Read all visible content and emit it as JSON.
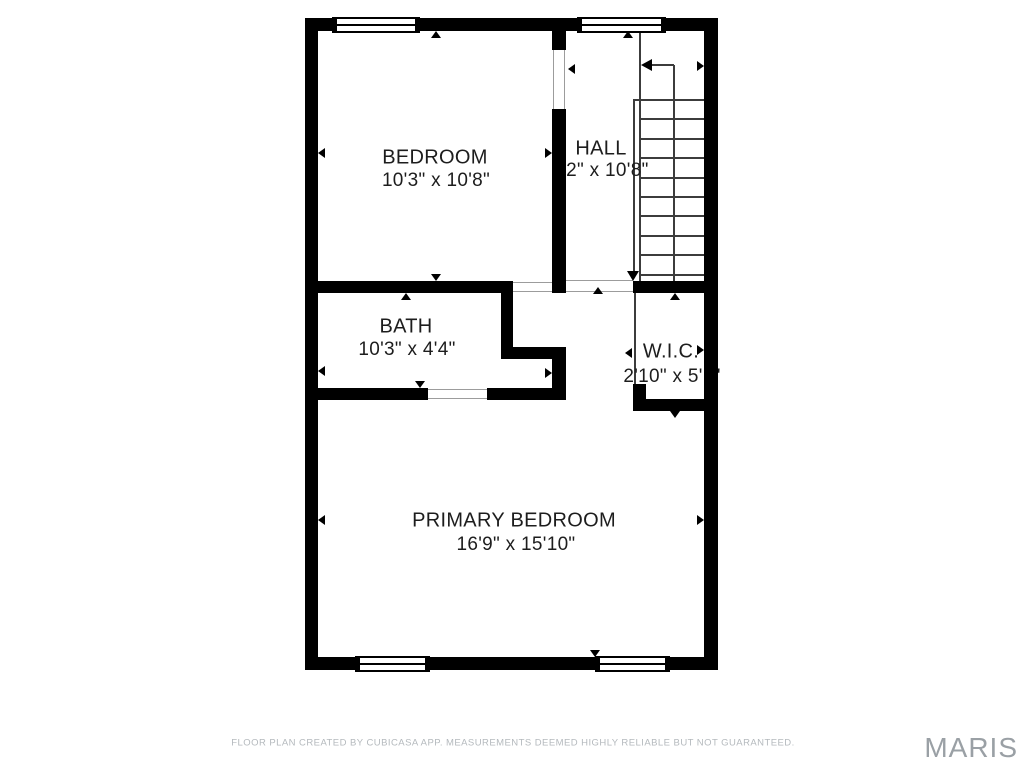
{
  "rooms": [
    {
      "label": "BEDROOM",
      "dims": "10'3\" x 10'8\""
    },
    {
      "label": "HALL",
      "dims": "3'2\" x 10'8\""
    },
    {
      "label": "BATH",
      "dims": "10'3\" x 4'4\""
    },
    {
      "label": "W.I.C.",
      "dims": "2'10\" x 5'1\""
    },
    {
      "label": "PRIMARY BEDROOM",
      "dims": "16'9\" x 15'10\""
    }
  ],
  "footer": {
    "disclaimer": "FLOOR PLAN CREATED BY CUBICASA APP. MEASUREMENTS DEEMED HIGHLY RELIABLE BUT NOT GUARANTEED."
  },
  "watermark": {
    "text": "MARIS"
  },
  "colors": {
    "wall": "#000000",
    "room_text": "#1d1d1d",
    "thin_line": "#3c3c3c",
    "door_threshold": "#9c9c9c",
    "footer_text": "#b4b9bd",
    "watermark_text": "#9aa0a5",
    "background": "#ffffff"
  },
  "floorplan": {
    "walls": [
      [
        305,
        18,
        413,
        13,
        "top-wall"
      ],
      [
        305,
        657,
        413,
        13,
        "bottom-wall"
      ],
      [
        305,
        18,
        13,
        652,
        "left-wall"
      ],
      [
        704,
        18,
        14,
        652,
        "right-wall"
      ],
      [
        552,
        31,
        14,
        19,
        "hall-bedroom-wall-upper"
      ],
      [
        552,
        109,
        14,
        184,
        "hall-bedroom-wall-main"
      ],
      [
        552,
        347,
        14,
        53,
        "hall-bedroom-wall-lower"
      ],
      [
        318,
        281,
        183,
        12,
        "bedroom-bath-wall"
      ],
      [
        501,
        281,
        12,
        78,
        "closet-left-wall"
      ],
      [
        501,
        347,
        65,
        12,
        "closet-bottom-wall"
      ],
      [
        318,
        388,
        110,
        12,
        "bath-bottom-wall-left"
      ],
      [
        487,
        388,
        79,
        12,
        "bath-bottom-wall-right"
      ],
      [
        633,
        281,
        71,
        12,
        "stairs-bottom-wall"
      ],
      [
        633,
        384,
        13,
        15,
        "wic-corner-stub"
      ],
      [
        633,
        399,
        71,
        12,
        "wic-bottom-wall"
      ]
    ],
    "thin_lines": [
      [
        639,
        31,
        2,
        250,
        "stairs-edge-line"
      ],
      [
        633,
        99,
        2,
        173,
        "stair-railing-line"
      ],
      [
        673,
        65,
        2,
        216,
        "stair-walk-line"
      ],
      [
        650,
        64,
        24,
        2,
        "stair-arrow-tail"
      ],
      [
        633,
        99,
        71,
        2,
        "stair-tread-1"
      ],
      [
        640,
        118,
        64,
        2,
        "stair-tread-2"
      ],
      [
        640,
        138,
        64,
        2,
        "stair-tread-3"
      ],
      [
        640,
        157,
        64,
        2,
        "stair-tread-4"
      ],
      [
        640,
        177,
        64,
        2,
        "stair-tread-5"
      ],
      [
        640,
        196,
        64,
        2,
        "stair-tread-6"
      ],
      [
        640,
        215,
        64,
        2,
        "stair-tread-7"
      ],
      [
        640,
        235,
        64,
        2,
        "stair-tread-8"
      ],
      [
        640,
        254,
        64,
        2,
        "stair-tread-9"
      ],
      [
        640,
        274,
        64,
        2,
        "stair-tread-10"
      ],
      [
        634,
        293,
        2,
        106,
        "wic-door-line"
      ]
    ],
    "thresholds": [
      [
        553,
        50,
        1,
        59,
        "bedroom-door-jamb-left"
      ],
      [
        564,
        50,
        1,
        59,
        "bedroom-door-jamb-right"
      ],
      [
        513,
        282,
        40,
        1,
        "closet-door-edge-top"
      ],
      [
        513,
        291,
        40,
        1,
        "closet-door-edge-bottom"
      ],
      [
        428,
        389,
        59,
        1,
        "bath-door-edge-top"
      ],
      [
        428,
        398,
        59,
        1,
        "bath-door-edge-bottom"
      ],
      [
        566,
        280,
        67,
        1,
        "hall-opening-edge-top"
      ],
      [
        566,
        291,
        67,
        1,
        "hall-opening-edge-bottom"
      ]
    ],
    "windows": [
      [
        332,
        17,
        88,
        16,
        "bedroom-window"
      ],
      [
        577,
        17,
        89,
        16,
        "hall-window"
      ],
      [
        355,
        656,
        75,
        16,
        "primary-bedroom-window-left"
      ],
      [
        595,
        656,
        75,
        16,
        "primary-bedroom-window-right"
      ]
    ],
    "ticks": [
      [
        436,
        31,
        "up",
        "tick-bedroom-top"
      ],
      [
        628,
        31,
        "up",
        "tick-hall-top"
      ],
      [
        318,
        153,
        "left",
        "tick-bedroom-left"
      ],
      [
        552,
        153,
        "right",
        "tick-bedroom-right"
      ],
      [
        568,
        69,
        "left",
        "tick-hall-left"
      ],
      [
        704,
        66,
        "right",
        "tick-hall-right"
      ],
      [
        436,
        281,
        "down",
        "tick-bedroom-bottom"
      ],
      [
        406,
        293,
        "up",
        "tick-bath-top"
      ],
      [
        318,
        371,
        "left",
        "tick-bath-left"
      ],
      [
        552,
        373,
        "right",
        "tick-bath-right"
      ],
      [
        420,
        388,
        "down",
        "tick-bath-bottom"
      ],
      [
        598,
        287,
        "up",
        "tick-corridor-opening"
      ],
      [
        675,
        293,
        "up",
        "tick-wic-top"
      ],
      [
        625,
        353,
        "left",
        "tick-wic-left"
      ],
      [
        704,
        350,
        "right",
        "tick-wic-right"
      ],
      [
        675,
        418,
        "down",
        "tick-wic-bottom"
      ],
      [
        318,
        520,
        "left",
        "tick-primary-left"
      ],
      [
        704,
        520,
        "right",
        "tick-primary-right"
      ],
      [
        595,
        657,
        "down",
        "tick-primary-bottom"
      ]
    ],
    "stair_arrows": [
      [
        641,
        65,
        "left",
        6,
        11,
        "stair-up-arrowhead"
      ],
      [
        633,
        281,
        "down",
        6,
        10,
        "stair-railing-arrowhead"
      ]
    ]
  }
}
